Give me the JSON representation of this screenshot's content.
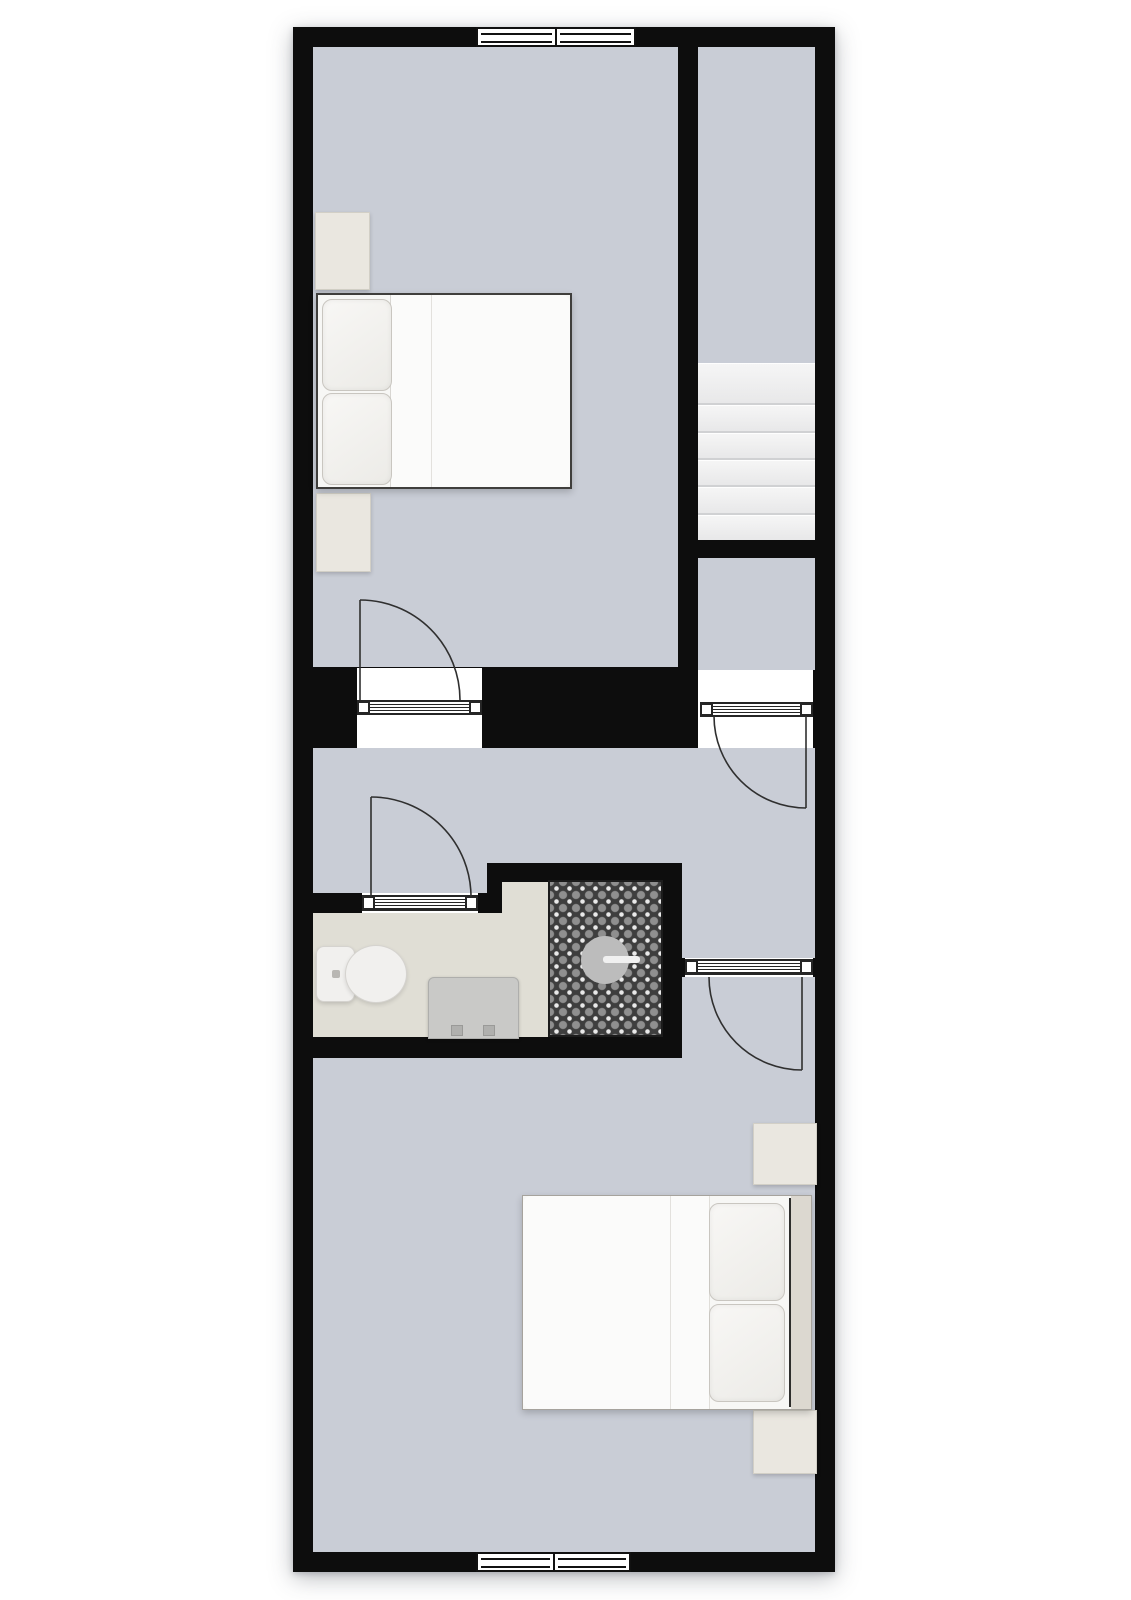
{
  "plan": {
    "type": "floor-plan-top-view",
    "visible_text": "",
    "rooms": [
      {
        "id": "bedroom-top",
        "floor_color": "#c9cdd6",
        "furniture": [
          "double-bed",
          "pillow",
          "pillow",
          "nightstand",
          "nightstand"
        ],
        "windows": 1,
        "doors": 1
      },
      {
        "id": "stairwell",
        "floor_color": "#c9cdd6",
        "features": [
          "staircase"
        ]
      },
      {
        "id": "stair-landing",
        "floor_color": "#c9cdd6",
        "doors": 1
      },
      {
        "id": "hallway",
        "floor_color": "#c9cdd6",
        "doors": 3
      },
      {
        "id": "bathroom",
        "floor_color": "#e0ded5",
        "fixtures": [
          "toilet",
          "washbasin-cabinet",
          "walk-in-shower",
          "shower-drain"
        ],
        "shower_tile": "dark-ornamental-pattern"
      },
      {
        "id": "bedroom-bottom",
        "floor_color": "#c9cdd6",
        "furniture": [
          "double-bed",
          "pillow",
          "pillow",
          "nightstand",
          "nightstand"
        ],
        "windows": 1,
        "doors": 1
      }
    ],
    "stairs": {
      "tread_count": 6,
      "direction": "vertical"
    },
    "windows": [
      {
        "id": "window-top",
        "wall": "north",
        "panes": 2
      },
      {
        "id": "window-bottom",
        "wall": "south",
        "panes": 2
      }
    ],
    "doors": [
      {
        "id": "door-bedroom-top",
        "hinge": "left",
        "swings": "into-top-bedroom"
      },
      {
        "id": "door-stair-landing",
        "hinge": "right",
        "swings": "into-hallway"
      },
      {
        "id": "door-bathroom",
        "hinge": "left",
        "swings": "into-hallway"
      },
      {
        "id": "door-bedroom-bottom",
        "hinge": "right",
        "swings": "into-bottom-bedroom"
      }
    ]
  },
  "colors": {
    "page": "#ffffff",
    "wall": "#0d0d0d",
    "floor": "#c9cdd6",
    "bathFloor": "#e0ded5",
    "tread": "#f6f6f6",
    "frame": "#111111",
    "doorline": "#2f2f2f",
    "tileDark": "#3e3e3e",
    "tileLight": "#e9e9e9",
    "beige": "#eae7e0",
    "headboard": "#dcd8d0",
    "bedWhite": "#f7f7f5",
    "duvet": "#fbfbfa",
    "pillow": "#ecebe7",
    "vanity": "#c9c9c7",
    "toilet": "#f1f0ee",
    "drain": "#bcbcbc"
  }
}
